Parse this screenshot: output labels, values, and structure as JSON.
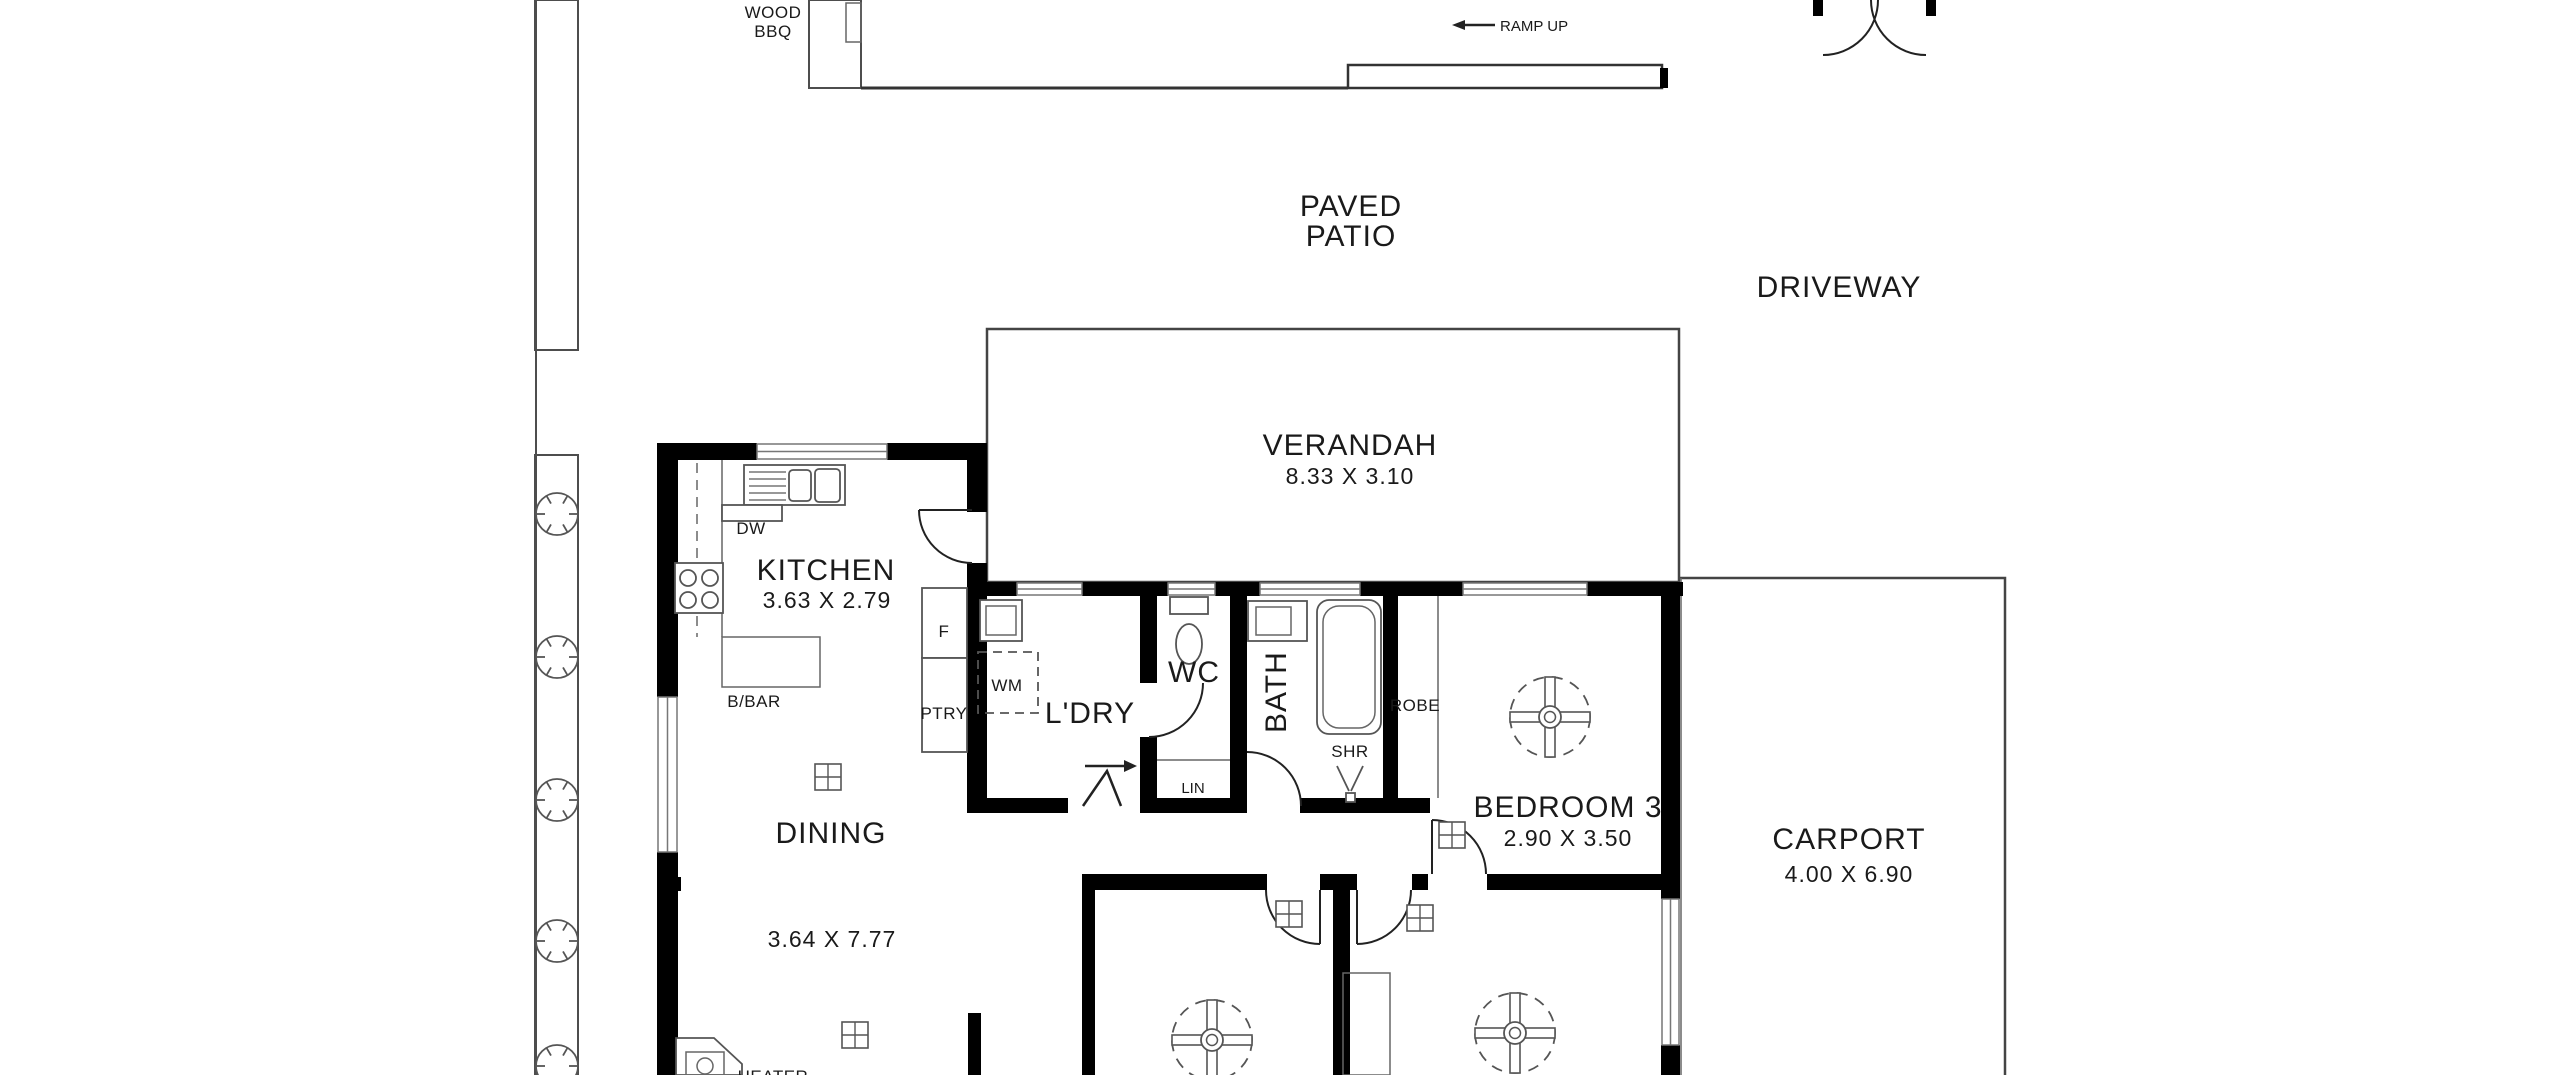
{
  "plan_type": "floor-plan",
  "outdoor": {
    "wood_bbq": [
      "WOOD",
      "BBQ"
    ],
    "ramp_up": "RAMP UP",
    "paved_patio": [
      "PAVED",
      "PATIO"
    ],
    "driveway": "DRIVEWAY"
  },
  "rooms": {
    "verandah": {
      "label": "VERANDAH",
      "dims": "8.33 X 3.10"
    },
    "kitchen": {
      "label": "KITCHEN",
      "dims": "3.63 X 2.79"
    },
    "dining": {
      "label": "DINING",
      "dims": "3.64 X 7.77"
    },
    "laundry": {
      "label": "L'DRY"
    },
    "wc": {
      "label": "WC"
    },
    "bath": {
      "label": "BATH"
    },
    "bedroom3": {
      "label": "BEDROOM 3",
      "dims": "2.90 X 3.50"
    },
    "carport": {
      "label": "CARPORT",
      "dims": "4.00 X 6.90"
    }
  },
  "fixtures": {
    "dishwasher": "DW",
    "washing_machine": "WM",
    "pantry": "PTRY",
    "fridge": "F",
    "breakfast_bar": "B/BAR",
    "robe_bedroom3": "ROBE",
    "robe_bedroom2": "ROBE",
    "shower": "SHR",
    "linen": "LIN",
    "heater": "HEATER"
  },
  "colors": {
    "walls": "#000000",
    "thin_lines": "#4d4d4d",
    "text": "#1a1a1a",
    "background": "#ffffff"
  }
}
